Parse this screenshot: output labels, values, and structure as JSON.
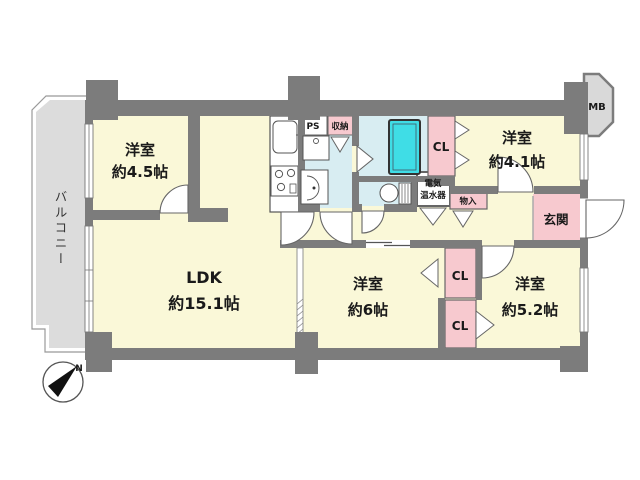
{
  "floor_plan": {
    "balcony_label": "バルコニー",
    "compass_north": "N",
    "rooms": {
      "western_top_left": {
        "name": "洋室",
        "size": "約4.5帖"
      },
      "ldk": {
        "name": "LDK",
        "size": "約15.1帖"
      },
      "western_middle": {
        "name": "洋室",
        "size": "約6帖"
      },
      "western_bottom_right": {
        "name": "洋室",
        "size": "約5.2帖"
      },
      "western_top_right": {
        "name": "洋室",
        "size": "約4.1帖"
      },
      "entrance": {
        "name": "玄関"
      }
    },
    "storage": {
      "closet_top": "CL",
      "closet_mid": "CL",
      "closet_bottom": "CL",
      "shuno": "収納",
      "monoire": "物入"
    },
    "utility": {
      "pipe_space": "PS",
      "meter_box": "MB",
      "water_heater_line1": "電気",
      "water_heater_line2": "温水器"
    },
    "colors": {
      "wall": "#7c7c7c",
      "room_fill": "#faf8d8",
      "wet_area_fill": "#d8edf2",
      "bathtub_fill": "#3fdde6",
      "closet_fill": "#f7c9cf",
      "balcony_fill": "#dcdcdc"
    }
  }
}
